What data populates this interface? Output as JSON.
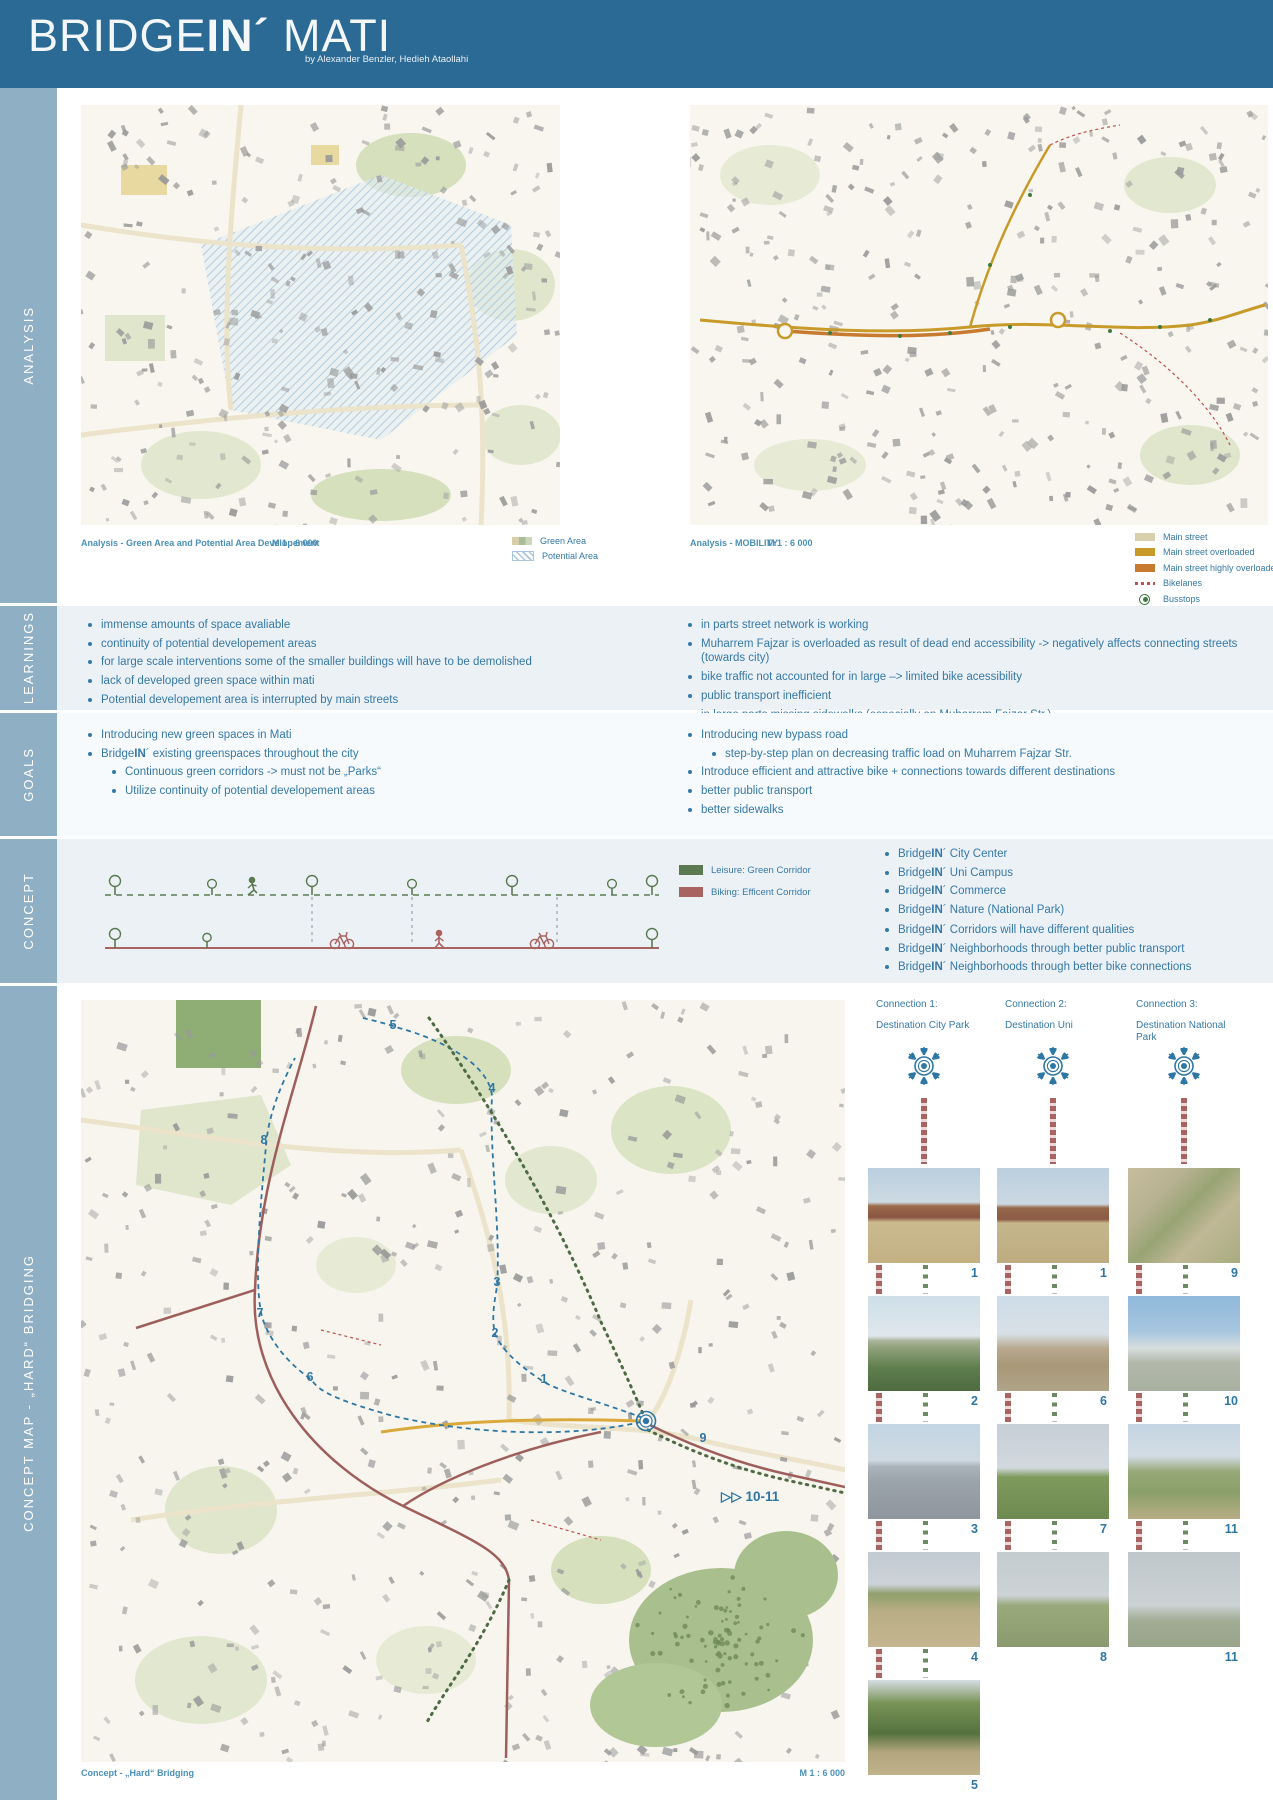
{
  "header": {
    "title": "BRIDGEIN´ MATI",
    "title_parts": {
      "bridge": "BRIDGE",
      "in": "IN´",
      "mati": " MATI"
    },
    "byline": "by Alexander Benzler, Hedieh Ataollahi",
    "bg_color": "#2b6a94"
  },
  "sidebar": {
    "bg_color": "#8fafc5",
    "sections": [
      {
        "label": "ANALYSIS"
      },
      {
        "label": "LEARNINGS"
      },
      {
        "label": "GOALS"
      },
      {
        "label": "CONCEPT"
      },
      {
        "label": "CONCEPT MAP - „HARD“ BRIDGING"
      }
    ]
  },
  "analysis": {
    "left_map": {
      "caption": "Analysis -  Green Area and Potential Area Developement",
      "scale": "M  1 : 6 000",
      "legend": [
        {
          "label": "Green Area",
          "swatch": "sw-green-area"
        },
        {
          "label": "Potential Area",
          "swatch": "sw-potential"
        }
      ]
    },
    "right_map": {
      "caption": "Analysis - MOBILITY",
      "scale": "M  1 : 6 000",
      "legend": [
        {
          "label": "Main street",
          "swatch": "sw-tan",
          "color": "#d8cfac"
        },
        {
          "label": "Main street overloaded",
          "swatch": "sw-gold",
          "color": "#c89a2a"
        },
        {
          "label": "Main street highly overloaded",
          "swatch": "sw-orange",
          "color": "#c87a30"
        },
        {
          "label": "Bikelanes",
          "swatch": "sw-bikelane",
          "color": "#c0504d"
        },
        {
          "label": "Busstops",
          "swatch": "sw-busstop",
          "color": "#3f7a3f"
        },
        {
          "label": "Dead end",
          "swatch": "sw-deadend",
          "color": "#c0504d"
        }
      ]
    }
  },
  "learnings": {
    "left": [
      {
        "text": "immense amounts of space avaliable",
        "level": 0
      },
      {
        "text": "continuity of potential developement areas",
        "level": 0
      },
      {
        "text": "for large scale interventions some of the smaller buildings will have to be demolished",
        "level": 0
      },
      {
        "text": "lack of developed green space within mati",
        "level": 0
      },
      {
        "text": "Potential developement area is interrupted by main streets",
        "level": 0
      }
    ],
    "right": [
      {
        "text": "in parts street network is working",
        "level": 0
      },
      {
        "text": "Muharrem Fajzar is overloaded as result of dead end accessibility -> negatively affects connecting streets (towards city)",
        "level": 0
      },
      {
        "text": "bike traffic not accounted for in large –> limited bike acessibility",
        "level": 0
      },
      {
        "text": "public transport inefficient",
        "level": 0
      },
      {
        "text": "in large parts missing sidewalks (especially on Muharrem Fajzar Str.)",
        "level": 0
      }
    ]
  },
  "goals": {
    "left": [
      {
        "text": "Introducing new green spaces in Mati",
        "level": 0
      },
      {
        "text": "BridgeIN´ existing greenspaces throughout the city",
        "level": 0
      },
      {
        "text": "Continuous green corridors -> must not be „Parks“",
        "level": 1
      },
      {
        "text": "Utilize continuity of potential developement areas",
        "level": 1
      }
    ],
    "right": [
      {
        "text": "Introducing new bypass road",
        "level": 0
      },
      {
        "text": "step-by-step plan on decreasing traffic load on Muharrem Fajzar Str.",
        "level": 1
      },
      {
        "text": "Introduce efficient and attractive bike + connections towards different destinations",
        "level": 0
      },
      {
        "text": "better public transport",
        "level": 0
      },
      {
        "text": "better sidewalks",
        "level": 0
      }
    ]
  },
  "concept": {
    "legend": [
      {
        "label": "Leisure: Green Corridor",
        "swatch": "sw-leisure",
        "color": "#5c7a52"
      },
      {
        "label": "Biking: Efficent Corridor",
        "swatch": "sw-biking",
        "color": "#a96461"
      }
    ],
    "group1": [
      {
        "text": "BridgeIN´ City Center",
        "level": 0
      },
      {
        "text": "BridgeIN´ Uni Campus",
        "level": 0
      },
      {
        "text": "BridgeIN´ Commerce",
        "level": 0
      },
      {
        "text": "BridgeIN´ Nature (National Park)",
        "level": 0
      }
    ],
    "group2": [
      {
        "text": "BridgeIN´ Corridors  will have different qualities",
        "level": 0
      },
      {
        "text": "BridgeIN´ Neighborhoods through better public transport",
        "level": 0
      },
      {
        "text": "BridgeIN´ Neighborhoods through better bike connections",
        "level": 0
      }
    ],
    "colors": {
      "green_corridor": "#5c7a52",
      "bike_corridor": "#a96461"
    }
  },
  "concept_map": {
    "caption": "Concept - „Hard“ Bridging",
    "scale": "M  1 : 6 000",
    "annotation": "▷▷ 10-11",
    "markers": [
      {
        "n": "5",
        "x": 312,
        "y": 25
      },
      {
        "n": "4",
        "x": 411,
        "y": 88
      },
      {
        "n": "8",
        "x": 183,
        "y": 140
      },
      {
        "n": "7",
        "x": 179,
        "y": 313
      },
      {
        "n": "3",
        "x": 416,
        "y": 282
      },
      {
        "n": "2",
        "x": 414,
        "y": 333
      },
      {
        "n": "6",
        "x": 229,
        "y": 377
      },
      {
        "n": "1",
        "x": 463,
        "y": 379
      },
      {
        "n": "9",
        "x": 622,
        "y": 438
      }
    ]
  },
  "connections": {
    "columns": [
      {
        "title": "Connection 1:",
        "subtitle": "Destination City Park",
        "photos": [
          {
            "n": "1",
            "style": "p1"
          },
          {
            "n": "2",
            "style": "p2"
          },
          {
            "n": "3",
            "style": "p3"
          },
          {
            "n": "4",
            "style": "p4"
          },
          {
            "n": "5",
            "style": "p5"
          }
        ]
      },
      {
        "title": "Connection 2:",
        "subtitle": "Destination Uni",
        "photos": [
          {
            "n": "1",
            "style": "p6"
          },
          {
            "n": "6",
            "style": "p7"
          },
          {
            "n": "7",
            "style": "p8"
          },
          {
            "n": "8",
            "style": "p9"
          }
        ]
      },
      {
        "title": "Connection 3:",
        "subtitle": "Destination National Park",
        "photos": [
          {
            "n": "9",
            "style": "p10"
          },
          {
            "n": "10",
            "style": "p11"
          },
          {
            "n": "11",
            "style": "p12"
          },
          {
            "n": "11",
            "style": "p13"
          }
        ]
      }
    ]
  }
}
